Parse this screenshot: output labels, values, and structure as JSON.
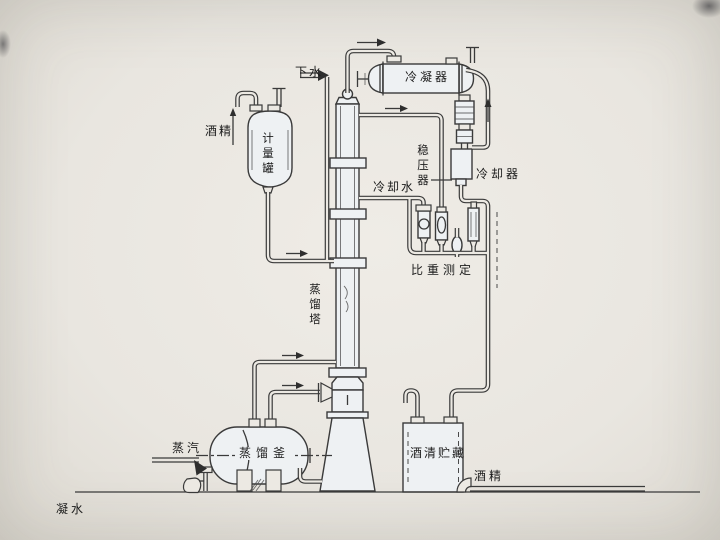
{
  "labels": {
    "drain_water": "下水",
    "condenser": "冷凝器",
    "alcohol_in": "酒精",
    "metering_tank": "计量罐",
    "pressure_stabilizer": "稳压器",
    "cooling_water": "冷却水",
    "cooler": "冷却器",
    "gravity_measurement": "比重测定",
    "distillation_column": "蒸馏塔",
    "distillation_kettle": "蒸馏釜",
    "steam": "蒸汽",
    "alcohol_storage": "酒清贮藏",
    "alcohol_out": "酒精",
    "condensate_water": "凝水"
  },
  "colors": {
    "background": "#e9e6e0",
    "line": "#3a3a3a",
    "vessel_fill": "#eef1f3",
    "label_text": "#1c1c1c"
  }
}
